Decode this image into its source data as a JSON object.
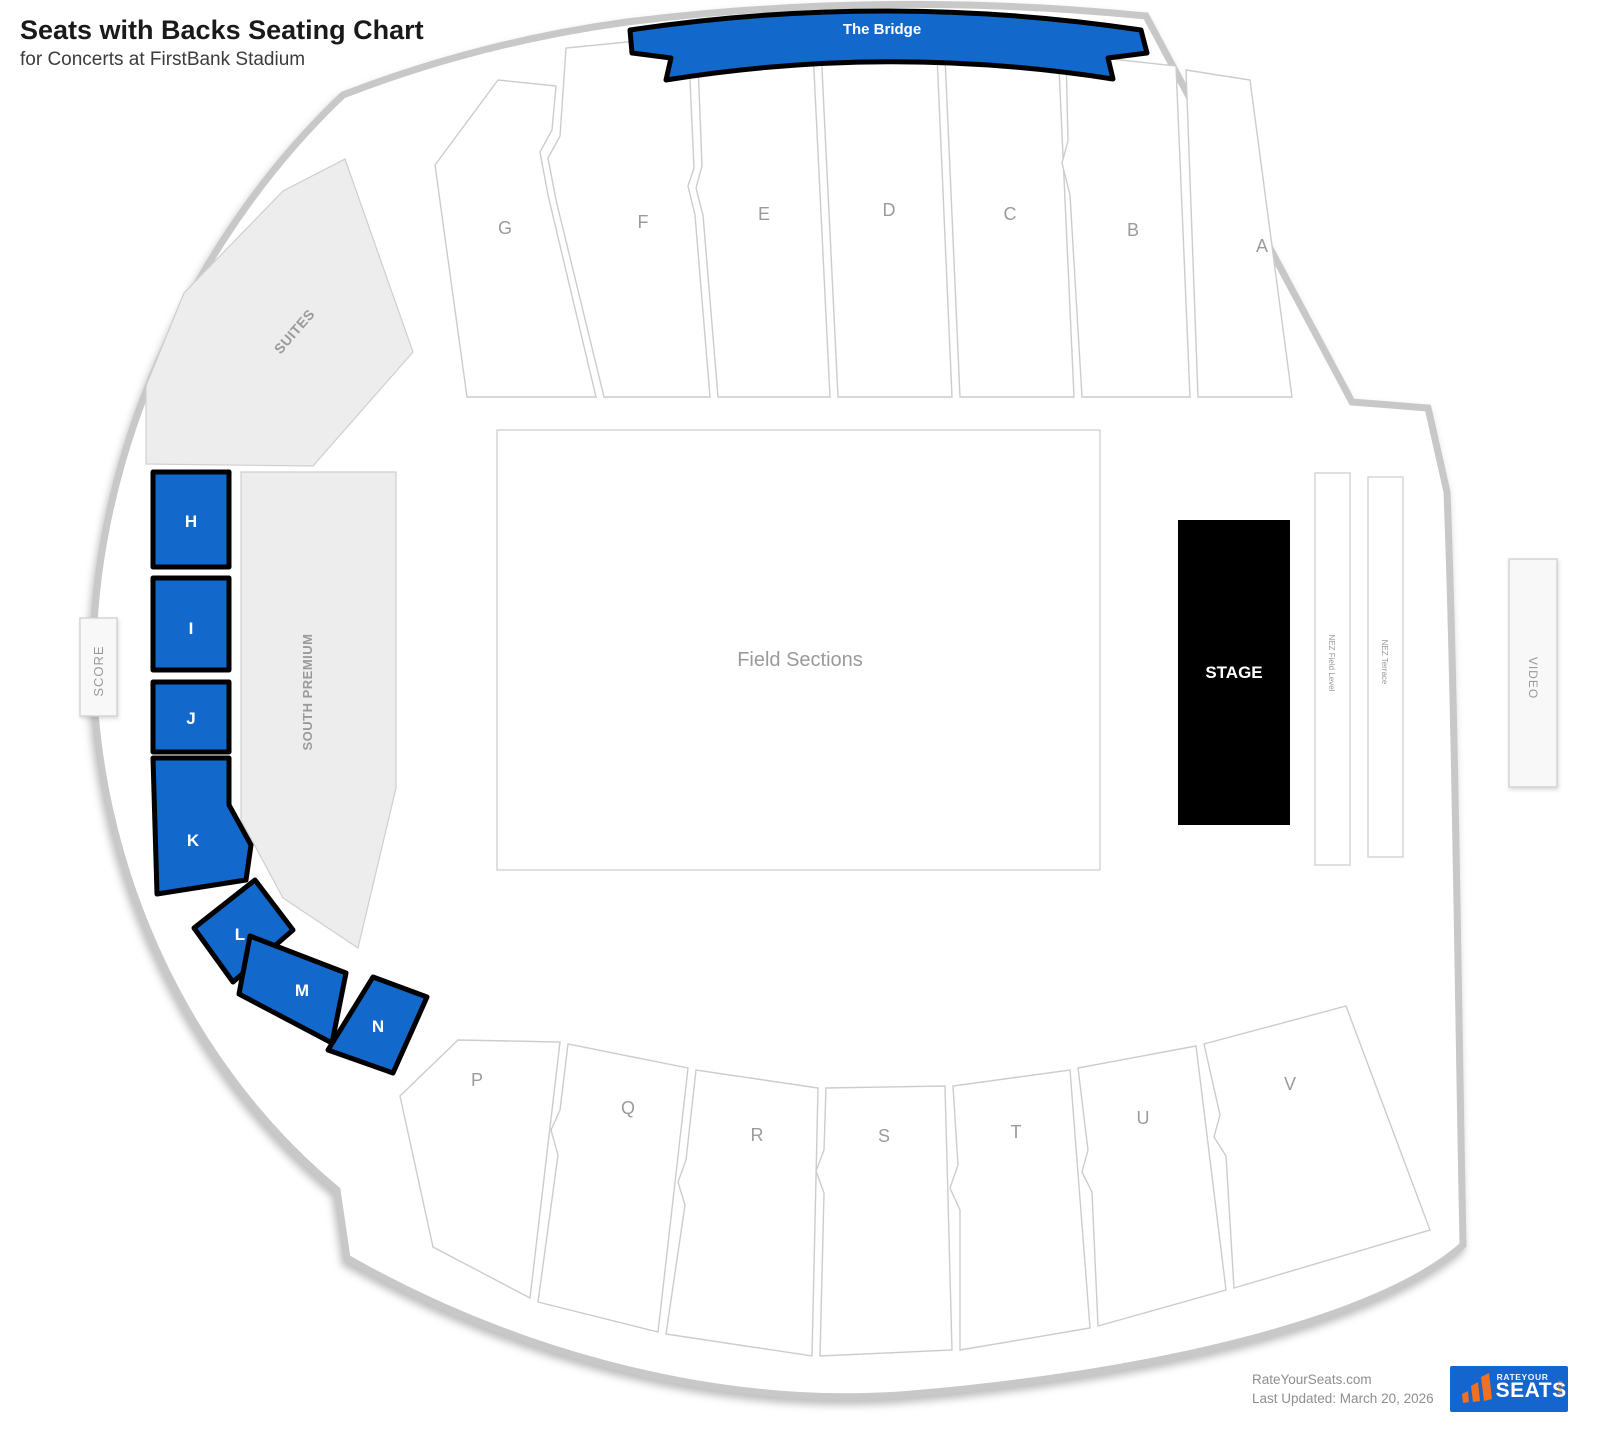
{
  "header": {
    "title": "Seats with Backs Seating Chart",
    "subtitle": "for Concerts at FirstBank Stadium"
  },
  "map": {
    "bridge_label": "The Bridge",
    "upper_sections": [
      "G",
      "F",
      "E",
      "D",
      "C",
      "B",
      "A"
    ],
    "lower_sections": [
      "P",
      "Q",
      "R",
      "S",
      "T",
      "U",
      "V"
    ],
    "highlighted_sections": [
      "H",
      "I",
      "J",
      "K",
      "L",
      "M",
      "N"
    ],
    "labels": {
      "suites": "SUITES",
      "south_premium": "SOUTH PREMIUM",
      "score": "SCORE",
      "video": "VIDEO",
      "nez_field_level": "NEZ Field Level",
      "nez_terrace": "NEZ Terrace",
      "field": "Field Sections",
      "stage": "STAGE"
    },
    "colors": {
      "highlight": "#1368cb",
      "outline": "#c8c8c8",
      "gray_fill": "#ededed",
      "section_border": "#cccccc",
      "stage_fill": "#000000"
    }
  },
  "footer": {
    "site": "RateYourSeats.com",
    "last_updated": "Last Updated: March 20, 2026",
    "logo": {
      "top": "RATEYOUR",
      "main": "SEATS",
      "side": ".COM"
    }
  }
}
